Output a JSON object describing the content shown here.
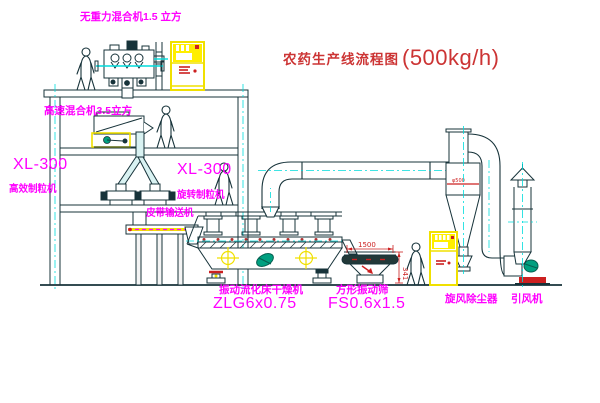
{
  "title": {
    "zh": "农药生产线流程图",
    "capacity": "(500kg/h)"
  },
  "labels": {
    "mixer_top": "无重力混合机1.5 立方",
    "mixer_mid": "高速混合机3.5立方",
    "granulator_left_model": "XL-300",
    "granulator_left_name": "高效制粒机",
    "granulator_mid_model": "XL-300",
    "granulator_mid_name": "旋转制粒机",
    "belt_conveyor": "皮带输送机",
    "dryer_name": "振动流化床干燥机",
    "dryer_model": "ZLG6x0.75",
    "screen_name": "方形振动筛",
    "screen_model": "FS0.6x1.5",
    "cyclone": "旋风除尘器",
    "fan": "引风机",
    "dim_width": "1500",
    "dim_height": "341",
    "cyclone_size": "φ500"
  },
  "colors": {
    "line": "#17333a",
    "centerline_cyan": "#00dcdc",
    "label_magenta": "#ff00ff",
    "title_red": "#cc3434",
    "dim_red": "#cc2020",
    "cabinet_yellow": "#f0e000",
    "motor_green": "#00a080"
  }
}
